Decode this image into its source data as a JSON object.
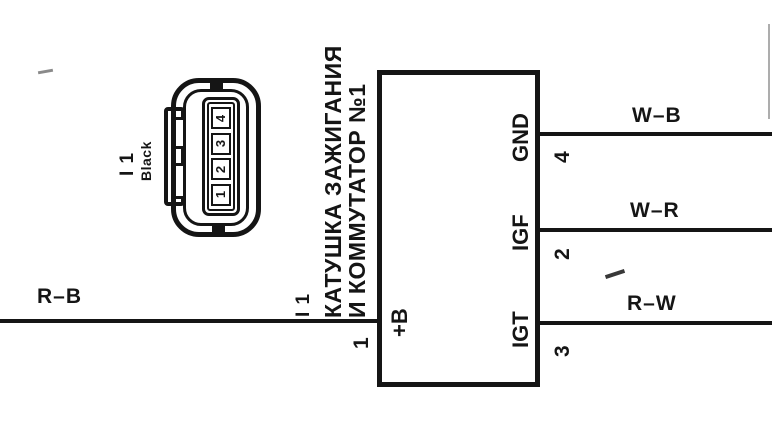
{
  "diagram": {
    "title_note": "wiring diagram segment",
    "connector": {
      "id": "I 1",
      "color_label": "Black",
      "pins": [
        "1",
        "2",
        "3",
        "4"
      ]
    },
    "component": {
      "name_line1": "КАТУШКА ЗАЖИГАНИЯ",
      "name_line2": "И КОММУТАТОР №1",
      "connector_ref": "I 1",
      "terminals": [
        {
          "label": "+B",
          "pin": "1",
          "wire": "R–B",
          "side": "left"
        },
        {
          "label": "GND",
          "pin": "4",
          "wire": "W–B",
          "side": "right"
        },
        {
          "label": "IGF",
          "pin": "2",
          "wire": "W–R",
          "side": "right"
        },
        {
          "label": "IGT",
          "pin": "3",
          "wire": "R–W",
          "side": "right"
        }
      ]
    },
    "colors": {
      "ink": "#151515",
      "background": "#ffffff"
    }
  }
}
